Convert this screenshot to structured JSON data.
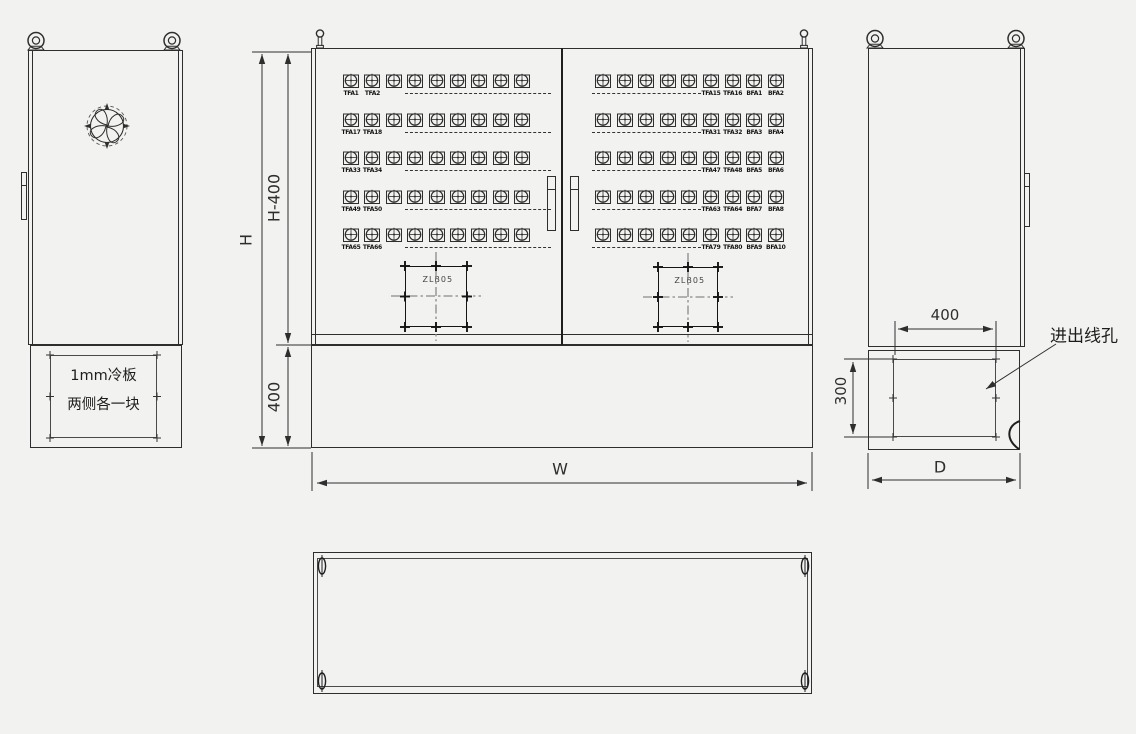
{
  "drawing_title": "cabinet-outline-drawing",
  "colors": {
    "background": "#f2f2f1",
    "line": "#2e2e2e"
  },
  "left_view": {
    "cold_plate_note": [
      "1mm冷板",
      "两侧各一块"
    ]
  },
  "front_view": {
    "junction_box_label": "ZLB05",
    "left_door": {
      "cols": 9,
      "rows": [
        {
          "labels": [
            "TFA1",
            "TFA2"
          ]
        },
        {
          "labels": [
            "TFA17",
            "TFA18"
          ]
        },
        {
          "labels": [
            "TFA33",
            "TFA34"
          ]
        },
        {
          "labels": [
            "TFA49",
            "TFA50"
          ]
        },
        {
          "labels": [
            "TFA65",
            "TFA66"
          ]
        }
      ]
    },
    "right_door": {
      "cols": 9,
      "rows": [
        {
          "labels": [
            "TFA15",
            "TFA16",
            "BFA1",
            "BFA2"
          ]
        },
        {
          "labels": [
            "TFA31",
            "TFA32",
            "BFA3",
            "BFA4"
          ]
        },
        {
          "labels": [
            "TFA47",
            "TFA48",
            "BFA5",
            "BFA6"
          ]
        },
        {
          "labels": [
            "TFA63",
            "TFA64",
            "BFA7",
            "BFA8"
          ]
        },
        {
          "labels": [
            "TFA79",
            "TFA80",
            "BFA9",
            "BFA10"
          ]
        }
      ]
    }
  },
  "dimensions": {
    "overall_height": "H",
    "body_height": "H-400",
    "base_height": "400",
    "overall_width": "W",
    "overall_depth": "D",
    "cable_hole_width": "400",
    "cable_hole_height": "300"
  },
  "annotations": {
    "cable_hole": "进出线孔"
  }
}
